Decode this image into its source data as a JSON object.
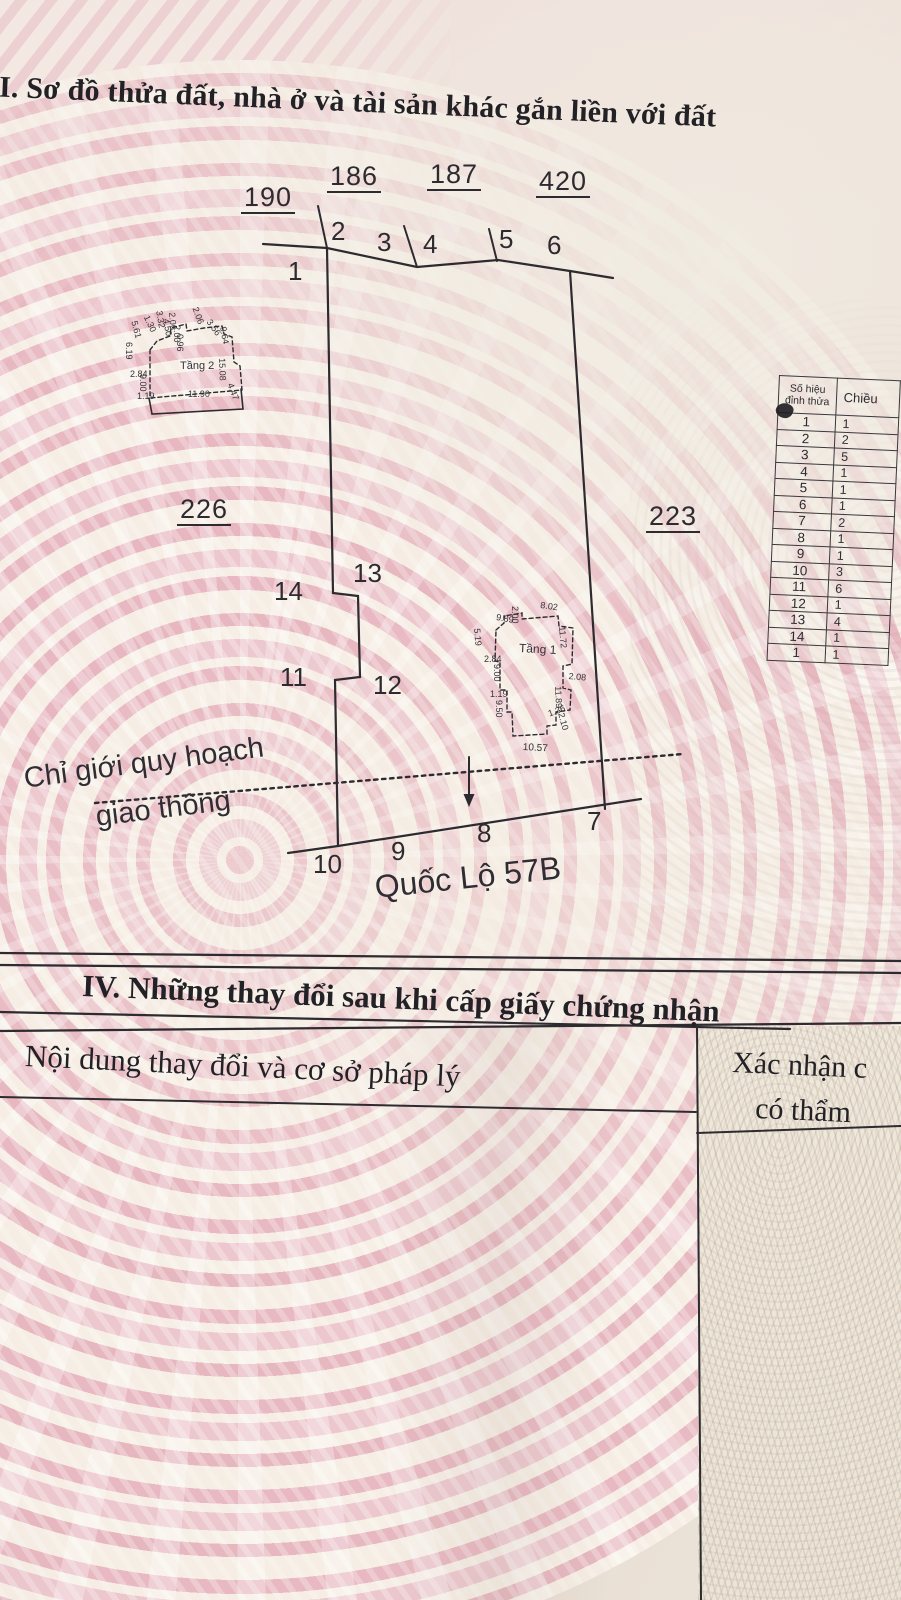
{
  "map_section": {
    "title": "II. Sơ đồ thửa đất, nhà ở và tài sản khác gắn liền với đất"
  },
  "diagram": {
    "parcels": {
      "n190": "190",
      "n186": "186",
      "n187": "187",
      "n420": "420",
      "n226": "226",
      "n223": "223"
    },
    "vertices": {
      "v1": "1",
      "v2": "2",
      "v3": "3",
      "v4": "4",
      "v5": "5",
      "v6": "6",
      "v7": "7",
      "v8": "8",
      "v9": "9",
      "v10": "10",
      "v11": "11",
      "v12": "12",
      "v13": "13",
      "v14": "14"
    },
    "planning_boundary_line1": "Chỉ giới quy hoạch",
    "planning_boundary_line2": "giao thông",
    "road_name": "Quốc Lộ 57B",
    "building_t2": {
      "label": "Tầng 2",
      "dims": [
        "1.19",
        "11.90",
        "2.84",
        "9.00",
        "6.19",
        "5.61",
        "1.30",
        "3.32",
        "4.50",
        "2.06",
        "2.00",
        "0.96",
        "2.06",
        "3.56",
        "9.64",
        "15.08",
        "4.47"
      ]
    },
    "building_t1": {
      "label": "Tầng 1",
      "dims": [
        "2.00",
        "8.02",
        "9.89",
        "5.19",
        "2.84",
        "9.00",
        "1.19",
        "9.50",
        "11.72",
        "2.08",
        "11.89",
        "1.36",
        "2.10",
        "10.57"
      ]
    }
  },
  "vertex_table": {
    "col1_header_line1": "Số hiệu",
    "col1_header_line2": "đỉnh thửa",
    "col2_header": "Chiều",
    "rows": [
      {
        "id": "1",
        "d": "1"
      },
      {
        "id": "2",
        "d": "2"
      },
      {
        "id": "3",
        "d": "5"
      },
      {
        "id": "4",
        "d": "1"
      },
      {
        "id": "5",
        "d": "1"
      },
      {
        "id": "6",
        "d": "1"
      },
      {
        "id": "7",
        "d": "2"
      },
      {
        "id": "8",
        "d": "1"
      },
      {
        "id": "9",
        "d": "1"
      },
      {
        "id": "10",
        "d": "3"
      },
      {
        "id": "11",
        "d": "6"
      },
      {
        "id": "12",
        "d": "1"
      },
      {
        "id": "13",
        "d": "4"
      },
      {
        "id": "14",
        "d": "1"
      },
      {
        "id": "1",
        "d": "1"
      }
    ]
  },
  "changes_section": {
    "title": "IV. Những thay đổi sau khi cấp giấy chứng nhận",
    "col1_header": "Nội dung thay đổi và cơ sở pháp lý",
    "col2_header_line1": "Xác nhận c",
    "col2_header_line2": "có thẩm"
  }
}
